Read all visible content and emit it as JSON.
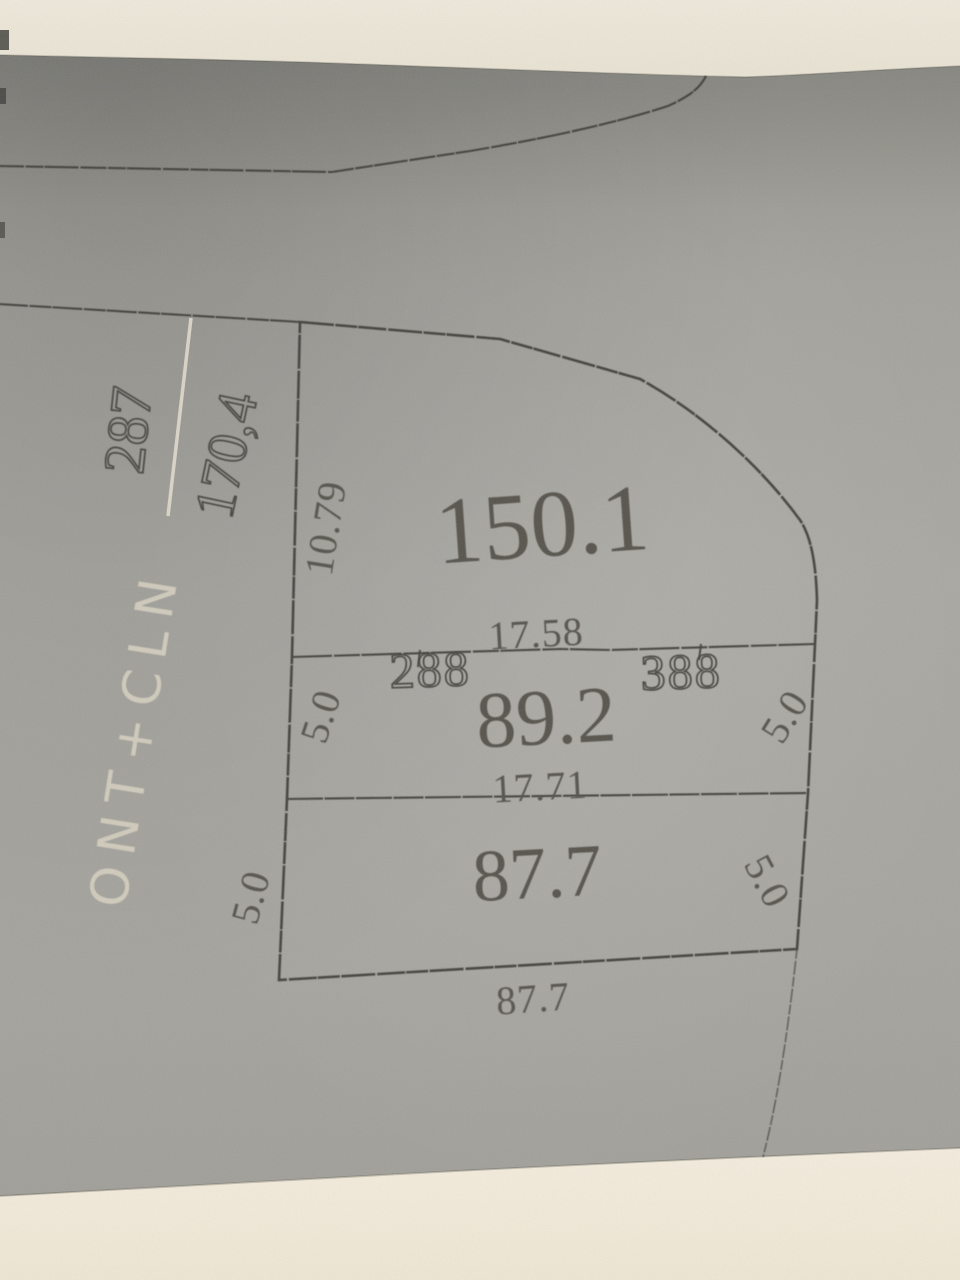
{
  "sketch": {
    "parcel": {
      "number": "287",
      "total_area": "170,4"
    },
    "handwritten_note": "ONT+CLN",
    "plots": [
      {
        "id": "top",
        "area": "150.1",
        "left_dim": "10.79",
        "bottom_dim": "17.58"
      },
      {
        "id": "middle",
        "area": "89.2",
        "left_dim": "5.0",
        "right_dim": "5.0",
        "bottom_dim": "17.71",
        "corner_marker_left": "288",
        "corner_marker_right": "388"
      },
      {
        "id": "bottom",
        "area": "87.7",
        "left_dim": "5.0",
        "right_dim": "5.0",
        "bottom_dim": "87.7"
      }
    ],
    "colors": {
      "paper_gray": "#a2a19d",
      "paper_gray_dark": "#90908c",
      "background_top": "#ece6d7",
      "background_bottom": "#f4ecdc",
      "line_ink": "#3b3a35",
      "number_ink": "#55534c",
      "white_ink": "#ddd6c5"
    }
  }
}
